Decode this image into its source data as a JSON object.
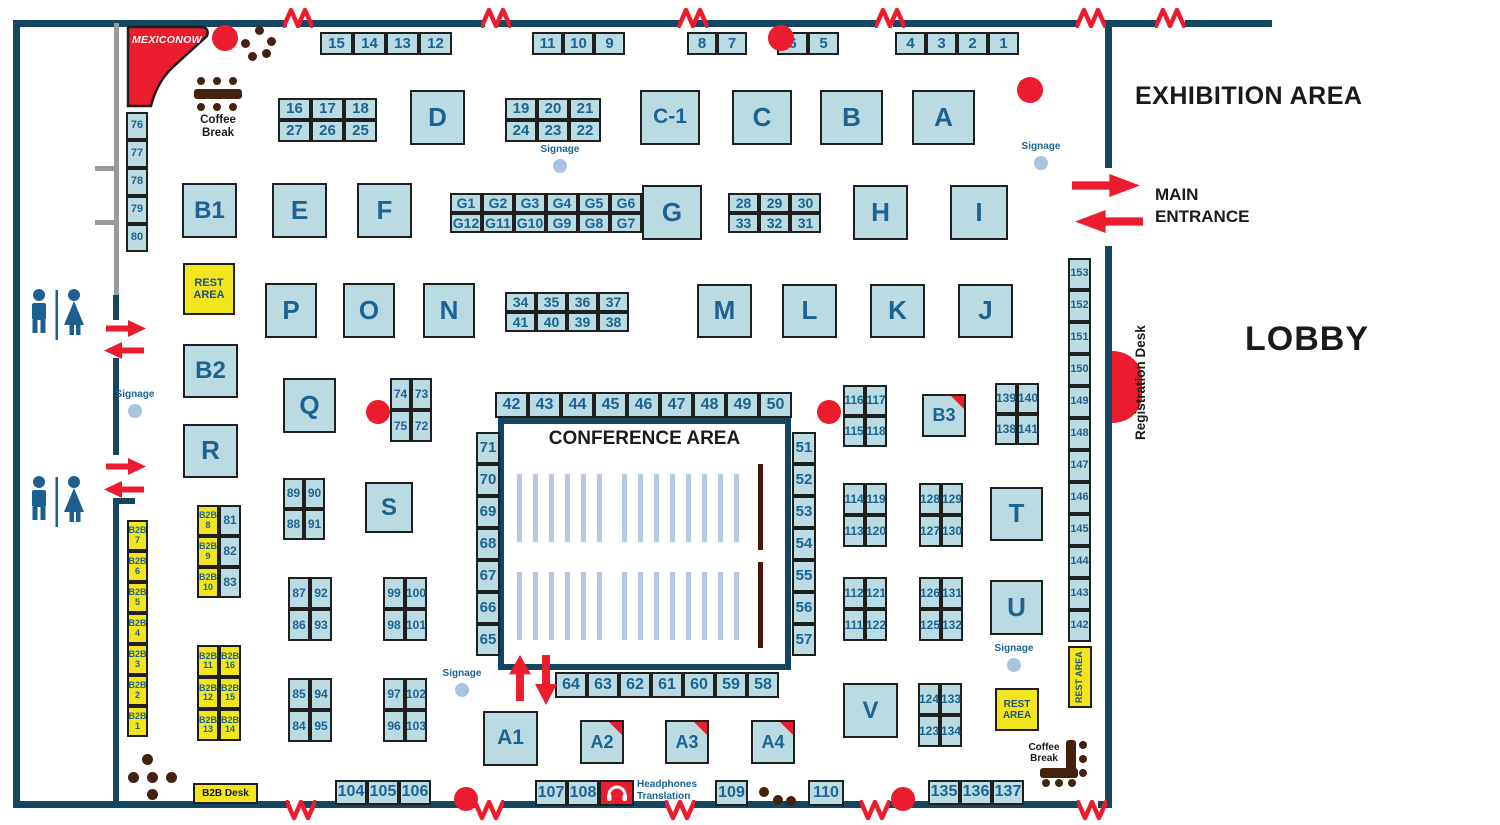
{
  "labels": {
    "exhibition_area": "EXHIBITION AREA",
    "lobby": "LOBBY",
    "main_entrance": "MAIN\nENTRANCE",
    "conference_area": "CONFERENCE AREA",
    "registration_desk": "Registration Desk",
    "coffee_break": "Coffee Break",
    "rest_area": "REST\nAREA",
    "b2b_desk": "B2B Desk",
    "signage": "Signage",
    "headphones_translation": "Headphones\nTranslation",
    "brand": "MEXICONOW"
  },
  "colors": {
    "wall": "#15465f",
    "booth_fill": "#b9dbe1",
    "booth_border": "#1f1f1f",
    "booth_text": "#1d6392",
    "yellow": "#f2e41f",
    "red": "#ea1c2d",
    "brown": "#45220f",
    "maroon": "#4a150b",
    "chair": "#b5c7e2",
    "signage_dot": "#a9c4df",
    "gray": "#9a9a9a",
    "black_text": "#1a1a1a"
  },
  "walls": [
    [
      13,
      20,
      274,
      7
    ],
    [
      300,
      20,
      185,
      7
    ],
    [
      498,
      20,
      182,
      7
    ],
    [
      695,
      20,
      183,
      7
    ],
    [
      893,
      20,
      185,
      7
    ],
    [
      1103,
      20,
      54,
      7
    ],
    [
      1185,
      20,
      87,
      7
    ],
    [
      13,
      20,
      7,
      788
    ],
    [
      1105,
      20,
      7,
      148
    ],
    [
      1105,
      246,
      7,
      562
    ],
    [
      13,
      801,
      277,
      7
    ],
    [
      303,
      801,
      174,
      7
    ],
    [
      501,
      801,
      167,
      7
    ],
    [
      694,
      801,
      169,
      7
    ],
    [
      889,
      801,
      191,
      7
    ],
    [
      1098,
      801,
      14,
      7
    ],
    [
      113,
      295,
      6,
      25
    ],
    [
      113,
      358,
      6,
      97
    ],
    [
      113,
      498,
      6,
      304
    ],
    [
      113,
      498,
      22,
      6
    ]
  ],
  "gray_lines": [
    [
      114,
      23,
      5,
      272
    ],
    [
      95,
      166,
      24,
      5
    ],
    [
      95,
      220,
      24,
      5
    ]
  ],
  "zigzags": {
    "top_x": [
      283,
      481,
      678,
      875,
      1076,
      1155
    ],
    "top_y": 6,
    "bottom_x": [
      286,
      474,
      665,
      860,
      1077
    ],
    "bottom_y": 800
  },
  "booths": [
    {
      "t": "D",
      "x": 410,
      "y": 90,
      "w": 55,
      "h": 55,
      "fs": 26
    },
    {
      "t": "C-1",
      "x": 640,
      "y": 90,
      "w": 60,
      "h": 55,
      "fs": 21
    },
    {
      "t": "C",
      "x": 732,
      "y": 90,
      "w": 60,
      "h": 55,
      "fs": 26
    },
    {
      "t": "B",
      "x": 820,
      "y": 90,
      "w": 63,
      "h": 55,
      "fs": 26
    },
    {
      "t": "A",
      "x": 912,
      "y": 90,
      "w": 63,
      "h": 55,
      "fs": 26
    },
    {
      "t": "B1",
      "x": 182,
      "y": 183,
      "w": 55,
      "h": 55,
      "fs": 24
    },
    {
      "t": "E",
      "x": 272,
      "y": 183,
      "w": 55,
      "h": 55,
      "fs": 26
    },
    {
      "t": "F",
      "x": 357,
      "y": 183,
      "w": 55,
      "h": 55,
      "fs": 26
    },
    {
      "t": "G",
      "x": 642,
      "y": 185,
      "w": 60,
      "h": 55,
      "fs": 26
    },
    {
      "t": "H",
      "x": 853,
      "y": 185,
      "w": 55,
      "h": 55,
      "fs": 26
    },
    {
      "t": "I",
      "x": 950,
      "y": 185,
      "w": 58,
      "h": 55,
      "fs": 26
    },
    {
      "t": "P",
      "x": 265,
      "y": 283,
      "w": 52,
      "h": 55,
      "fs": 26
    },
    {
      "t": "O",
      "x": 343,
      "y": 283,
      "w": 52,
      "h": 55,
      "fs": 26
    },
    {
      "t": "N",
      "x": 423,
      "y": 283,
      "w": 52,
      "h": 55,
      "fs": 26
    },
    {
      "t": "M",
      "x": 697,
      "y": 284,
      "w": 55,
      "h": 54,
      "fs": 26
    },
    {
      "t": "L",
      "x": 782,
      "y": 284,
      "w": 55,
      "h": 54,
      "fs": 26
    },
    {
      "t": "K",
      "x": 870,
      "y": 284,
      "w": 55,
      "h": 54,
      "fs": 26
    },
    {
      "t": "J",
      "x": 958,
      "y": 284,
      "w": 55,
      "h": 54,
      "fs": 26
    },
    {
      "t": "B2",
      "x": 183,
      "y": 344,
      "w": 55,
      "h": 54,
      "fs": 24
    },
    {
      "t": "Q",
      "x": 283,
      "y": 378,
      "w": 53,
      "h": 55,
      "fs": 26
    },
    {
      "t": "R",
      "x": 183,
      "y": 424,
      "w": 55,
      "h": 54,
      "fs": 26
    },
    {
      "t": "S",
      "x": 365,
      "y": 482,
      "w": 48,
      "h": 51,
      "fs": 24
    },
    {
      "t": "B3",
      "x": 922,
      "y": 394,
      "w": 44,
      "h": 43,
      "fs": 18,
      "corner": true
    },
    {
      "t": "T",
      "x": 990,
      "y": 487,
      "w": 53,
      "h": 54,
      "fs": 26
    },
    {
      "t": "U",
      "x": 990,
      "y": 580,
      "w": 53,
      "h": 55,
      "fs": 26
    },
    {
      "t": "V",
      "x": 843,
      "y": 683,
      "w": 55,
      "h": 55,
      "fs": 24
    },
    {
      "t": "A1",
      "x": 483,
      "y": 711,
      "w": 55,
      "h": 55,
      "fs": 21
    },
    {
      "t": "A2",
      "x": 580,
      "y": 720,
      "w": 44,
      "h": 44,
      "fs": 18,
      "corner": true
    },
    {
      "t": "A3",
      "x": 665,
      "y": 720,
      "w": 44,
      "h": 44,
      "fs": 18,
      "corner": true
    },
    {
      "t": "A4",
      "x": 751,
      "y": 720,
      "w": 44,
      "h": 44,
      "fs": 18,
      "corner": true
    }
  ],
  "grids": [
    {
      "x": 320,
      "y": 32,
      "cw": 33,
      "ch": 23,
      "cols": 4,
      "fs": 15,
      "cells": [
        "15",
        "14",
        "13",
        "12"
      ]
    },
    {
      "x": 532,
      "y": 32,
      "cw": 31,
      "ch": 23,
      "cols": 3,
      "fs": 15,
      "cells": [
        "11",
        "10",
        "9"
      ]
    },
    {
      "x": 687,
      "y": 32,
      "cw": 30,
      "ch": 23,
      "cols": 2,
      "fs": 15,
      "cells": [
        "8",
        "7"
      ]
    },
    {
      "x": 777,
      "y": 32,
      "cw": 31,
      "ch": 23,
      "cols": 2,
      "fs": 15,
      "cells": [
        "6",
        "5"
      ]
    },
    {
      "x": 895,
      "y": 32,
      "cw": 31,
      "ch": 23,
      "cols": 4,
      "fs": 15,
      "cells": [
        "4",
        "3",
        "2",
        "1"
      ]
    },
    {
      "x": 278,
      "y": 98,
      "cw": 33,
      "ch": 22,
      "cols": 3,
      "fs": 15,
      "cells": [
        "16",
        "17",
        "18",
        "27",
        "26",
        "25"
      ]
    },
    {
      "x": 505,
      "y": 98,
      "cw": 32,
      "ch": 22,
      "cols": 3,
      "fs": 15,
      "cells": [
        "19",
        "20",
        "21",
        "24",
        "23",
        "22"
      ]
    },
    {
      "x": 450,
      "y": 193,
      "cw": 32,
      "ch": 20,
      "cols": 6,
      "fs": 14,
      "cells": [
        "G1",
        "G2",
        "G3",
        "G4",
        "G5",
        "G6",
        "G12",
        "G11",
        "G10",
        "G9",
        "G8",
        "G7"
      ]
    },
    {
      "x": 728,
      "y": 193,
      "cw": 31,
      "ch": 20,
      "cols": 3,
      "fs": 14,
      "cells": [
        "28",
        "29",
        "30",
        "33",
        "32",
        "31"
      ]
    },
    {
      "x": 505,
      "y": 292,
      "cw": 31,
      "ch": 20,
      "cols": 4,
      "fs": 14,
      "cells": [
        "34",
        "35",
        "36",
        "37",
        "41",
        "40",
        "39",
        "38"
      ]
    },
    {
      "x": 390,
      "y": 378,
      "cw": 21,
      "ch": 32,
      "cols": 2,
      "fs": 12,
      "cells": [
        "74",
        "73",
        "75",
        "72"
      ]
    },
    {
      "x": 495,
      "y": 392,
      "cw": 33,
      "ch": 26,
      "cols": 9,
      "fs": 16,
      "cells": [
        "42",
        "43",
        "44",
        "45",
        "46",
        "47",
        "48",
        "49",
        "50"
      ]
    },
    {
      "x": 843,
      "y": 385,
      "cw": 22,
      "ch": 31,
      "cols": 2,
      "fs": 12,
      "cells": [
        "116",
        "117",
        "115",
        "118"
      ]
    },
    {
      "x": 995,
      "y": 383,
      "cw": 22,
      "ch": 31,
      "cols": 2,
      "fs": 12,
      "cells": [
        "139",
        "140",
        "138",
        "141"
      ]
    },
    {
      "x": 283,
      "y": 478,
      "cw": 21,
      "ch": 31,
      "cols": 2,
      "fs": 12,
      "cells": [
        "89",
        "90",
        "88",
        "91"
      ]
    },
    {
      "x": 288,
      "y": 577,
      "cw": 22,
      "ch": 32,
      "cols": 2,
      "fs": 12,
      "cells": [
        "87",
        "92",
        "86",
        "93"
      ]
    },
    {
      "x": 383,
      "y": 577,
      "cw": 22,
      "ch": 32,
      "cols": 2,
      "fs": 12,
      "cells": [
        "99",
        "100",
        "98",
        "101"
      ]
    },
    {
      "x": 288,
      "y": 678,
      "cw": 22,
      "ch": 32,
      "cols": 2,
      "fs": 12,
      "cells": [
        "85",
        "94",
        "84",
        "95"
      ]
    },
    {
      "x": 383,
      "y": 678,
      "cw": 22,
      "ch": 32,
      "cols": 2,
      "fs": 12,
      "cells": [
        "97",
        "102",
        "96",
        "103"
      ]
    },
    {
      "x": 843,
      "y": 483,
      "cw": 22,
      "ch": 32,
      "cols": 2,
      "fs": 12,
      "cells": [
        "114",
        "119",
        "113",
        "120"
      ]
    },
    {
      "x": 919,
      "y": 483,
      "cw": 22,
      "ch": 32,
      "cols": 2,
      "fs": 12,
      "cells": [
        "128",
        "129",
        "127",
        "130"
      ]
    },
    {
      "x": 843,
      "y": 577,
      "cw": 22,
      "ch": 32,
      "cols": 2,
      "fs": 12,
      "cells": [
        "112",
        "121",
        "111",
        "122"
      ]
    },
    {
      "x": 919,
      "y": 577,
      "cw": 22,
      "ch": 32,
      "cols": 2,
      "fs": 12,
      "cells": [
        "126",
        "131",
        "125",
        "132"
      ]
    },
    {
      "x": 918,
      "y": 683,
      "cw": 22,
      "ch": 32,
      "cols": 2,
      "fs": 12,
      "cells": [
        "124",
        "133",
        "123",
        "134"
      ]
    },
    {
      "x": 555,
      "y": 672,
      "cw": 32,
      "ch": 26,
      "cols": 7,
      "fs": 16,
      "cells": [
        "64",
        "63",
        "62",
        "61",
        "60",
        "59",
        "58"
      ]
    },
    {
      "x": 335,
      "y": 780,
      "cw": 32,
      "ch": 25,
      "cols": 3,
      "fs": 16,
      "cells": [
        "104",
        "105",
        "106"
      ]
    },
    {
      "x": 535,
      "y": 780,
      "cw": 32,
      "ch": 26,
      "cols": 2,
      "fs": 16,
      "cells": [
        "107",
        "108"
      ]
    },
    {
      "x": 715,
      "y": 780,
      "cw": 33,
      "ch": 26,
      "cols": 1,
      "fs": 16,
      "cells": [
        "109"
      ]
    },
    {
      "x": 808,
      "y": 780,
      "cw": 36,
      "ch": 26,
      "cols": 1,
      "fs": 16,
      "cells": [
        "110"
      ]
    },
    {
      "x": 928,
      "y": 780,
      "cw": 32,
      "ch": 25,
      "cols": 3,
      "fs": 16,
      "cells": [
        "135",
        "136",
        "137"
      ]
    },
    {
      "x": 126,
      "y": 112,
      "cw": 22,
      "ch": 28,
      "cols": 1,
      "fs": 11,
      "cells": [
        "76",
        "77",
        "78",
        "79",
        "80"
      ]
    },
    {
      "x": 1068,
      "y": 258,
      "cw": 23,
      "ch": 32,
      "cols": 1,
      "fs": 11,
      "cells": [
        "153",
        "152",
        "151",
        "150",
        "149",
        "148",
        "147",
        "146",
        "145",
        "144",
        "143",
        "142"
      ]
    },
    {
      "x": 476,
      "y": 432,
      "cw": 24,
      "ch": 32,
      "cols": 1,
      "fs": 15,
      "cells": [
        "71",
        "70",
        "69",
        "68",
        "67",
        "66",
        "65"
      ]
    },
    {
      "x": 792,
      "y": 432,
      "cw": 24,
      "ch": 32,
      "cols": 1,
      "fs": 15,
      "cells": [
        "51",
        "52",
        "53",
        "54",
        "55",
        "56",
        "57"
      ]
    },
    {
      "x": 127,
      "y": 520,
      "cw": 21,
      "ch": 31,
      "cols": 1,
      "fs": 9,
      "k": "y",
      "cells": [
        "B2B\n7",
        "B2B\n6",
        "B2B\n5",
        "B2B\n4",
        "B2B\n3",
        "B2B\n2",
        "B2B\n1"
      ]
    },
    {
      "x": 197,
      "y": 505,
      "cw": 22,
      "ch": 31,
      "cols": 2,
      "fs": 12,
      "cells": [
        {
          "t": "B2B\n8",
          "k": "y",
          "fs": 9
        },
        "81",
        {
          "t": "B2B\n9",
          "k": "y",
          "fs": 9
        },
        "82",
        {
          "t": "B2B\n10",
          "k": "y",
          "fs": 9
        },
        "83"
      ]
    },
    {
      "x": 197,
      "y": 645,
      "cw": 22,
      "ch": 32,
      "cols": 2,
      "fs": 9,
      "k": "y",
      "cells": [
        "B2B\n11",
        "B2B\n16",
        "B2B\n12",
        "B2B\n15",
        "B2B\n13",
        "B2B\n14"
      ]
    }
  ],
  "rest_areas": [
    {
      "x": 183,
      "y": 263,
      "w": 52,
      "h": 52,
      "fs": 11
    },
    {
      "x": 995,
      "y": 688,
      "w": 44,
      "h": 43,
      "fs": 10
    },
    {
      "x": 1068,
      "y": 646,
      "w": 24,
      "h": 62,
      "fs": 9,
      "vert": true
    }
  ],
  "red_dots": [
    [
      225,
      38,
      13
    ],
    [
      781,
      38,
      13
    ],
    [
      1030,
      90,
      13
    ],
    [
      378,
      412,
      12
    ],
    [
      829,
      412,
      12
    ],
    [
      466,
      799,
      12
    ],
    [
      903,
      799,
      12
    ]
  ],
  "brown_dots": [
    [
      245,
      43,
      4.5
    ],
    [
      259,
      30,
      4.5
    ],
    [
      271,
      41,
      4.5
    ],
    [
      252,
      56,
      4.5
    ],
    [
      266,
      53,
      4.5
    ],
    [
      201,
      81,
      4
    ],
    [
      217,
      81,
      4
    ],
    [
      233,
      81,
      4
    ],
    [
      201,
      107,
      4
    ],
    [
      217,
      107,
      4
    ],
    [
      233,
      107,
      4
    ],
    [
      147,
      759,
      5.5
    ],
    [
      133,
      777,
      5.5
    ],
    [
      152,
      777,
      5.5
    ],
    [
      171,
      777,
      5.5
    ],
    [
      152,
      794,
      5.5
    ],
    [
      764,
      792,
      5
    ],
    [
      778,
      800,
      5
    ],
    [
      791,
      801,
      5
    ],
    [
      1083,
      745,
      4
    ],
    [
      1083,
      759,
      4
    ],
    [
      1083,
      773,
      4
    ],
    [
      1046,
      783,
      4
    ],
    [
      1059,
      783,
      4
    ],
    [
      1072,
      783,
      4
    ]
  ],
  "brown_bars": [
    [
      194,
      89,
      48,
      10
    ],
    [
      1066,
      740,
      10,
      36
    ],
    [
      1040,
      768,
      38,
      10
    ]
  ],
  "arrows": [
    {
      "x": 106,
      "y": 320,
      "w": 40,
      "h": 17,
      "dir": "right"
    },
    {
      "x": 104,
      "y": 342,
      "w": 40,
      "h": 17,
      "dir": "left"
    },
    {
      "x": 106,
      "y": 458,
      "w": 40,
      "h": 17,
      "dir": "right"
    },
    {
      "x": 104,
      "y": 481,
      "w": 40,
      "h": 17,
      "dir": "left"
    },
    {
      "x": 1072,
      "y": 174,
      "w": 68,
      "h": 23,
      "dir": "right"
    },
    {
      "x": 1075,
      "y": 210,
      "w": 68,
      "h": 23,
      "dir": "left"
    },
    {
      "x": 509,
      "y": 655,
      "w": 22,
      "h": 46,
      "dir": "up"
    },
    {
      "x": 535,
      "y": 655,
      "w": 22,
      "h": 50,
      "dir": "down"
    }
  ],
  "signage_points": [
    {
      "x": 560,
      "y": 158
    },
    {
      "x": 1041,
      "y": 155
    },
    {
      "x": 135,
      "y": 403
    },
    {
      "x": 462,
      "y": 682
    },
    {
      "x": 1014,
      "y": 657
    }
  ],
  "conference": {
    "chairs": {
      "starts": [
        517,
        622
      ],
      "counts": [
        6,
        8
      ],
      "step": 16,
      "w": 5,
      "h": 68,
      "rows_y": [
        474,
        572
      ]
    },
    "maroon": [
      [
        758,
        464,
        5,
        86
      ],
      [
        758,
        562,
        5,
        86
      ]
    ]
  }
}
